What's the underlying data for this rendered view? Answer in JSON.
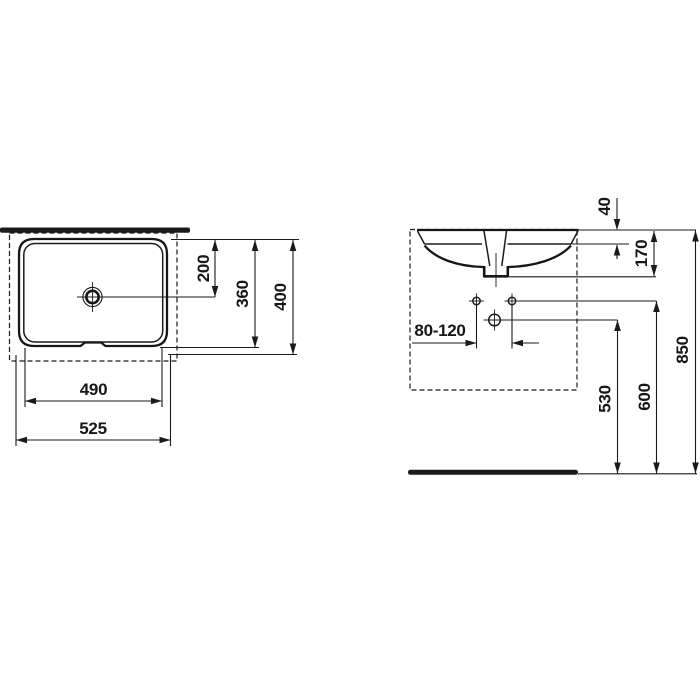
{
  "drawing": {
    "description": "washbasin installation drawing, plan view and front elevation",
    "colors": {
      "background": "#ffffff",
      "line": "#1a1a1a"
    },
    "plan_view": {
      "dims": {
        "drain_center_from_front": "200",
        "basin_inner_depth": "360",
        "overall_depth": "400",
        "basin_inner_width": "490",
        "overall_width": "525"
      }
    },
    "front_view": {
      "dims": {
        "rim_drop": "40",
        "outlet_drop": "170",
        "tap_hole_distance": "80-120",
        "outlet_height": "530",
        "fixing_hole_height": "600",
        "rim_height": "850"
      }
    }
  }
}
